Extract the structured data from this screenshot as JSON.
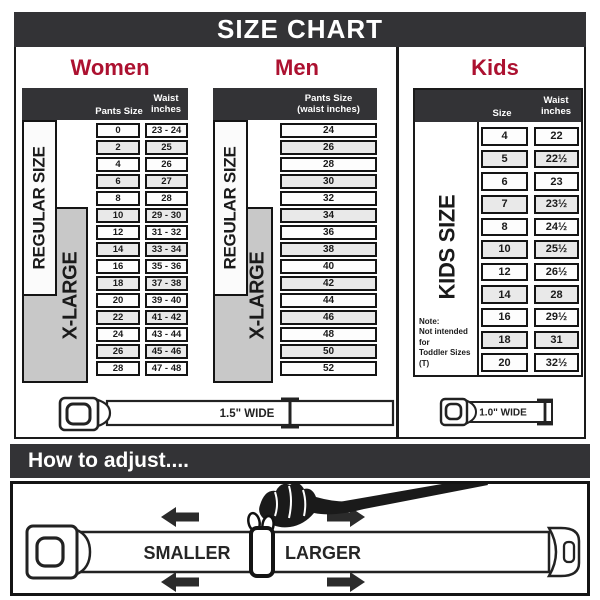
{
  "title": "SIZE CHART",
  "colors": {
    "banner_bg": "#333336",
    "accent_red": "#ac1130",
    "gray_box": "#c8c8c8",
    "border_black": "#1a1a1a"
  },
  "sections": {
    "women": {
      "label": "Women",
      "col1_header": "Pants Size",
      "col2_header_line1": "Waist",
      "col2_header_line2": "inches",
      "regular_label": "REGULAR SIZE",
      "xlarge_label": "X-LARGE"
    },
    "men": {
      "label": "Men",
      "header_line1": "Pants Size",
      "header_line2": "(waist inches)",
      "regular_label": "REGULAR SIZE",
      "xlarge_label": "X-LARGE"
    },
    "kids": {
      "label": "Kids",
      "col1_header": "Size",
      "col2_header_line1": "Waist",
      "col2_header_line2": "inches",
      "side_label": "KIDS SIZE",
      "note_line1": "Note:",
      "note_line2": "Not intended for",
      "note_line3": "Toddler Sizes (T)"
    }
  },
  "belts": {
    "adult_width_label": "1.5\" WIDE",
    "kids_width_label": "1.0\" WIDE"
  },
  "adjust": {
    "title": "How to adjust....",
    "smaller_label": "SMALLER",
    "larger_label": "LARGER"
  },
  "chart_data": [
    {
      "type": "table",
      "title": "Women",
      "columns": [
        "Pants Size",
        "Waist inches"
      ],
      "rows": [
        [
          "0",
          "23 - 24"
        ],
        [
          "2",
          "25"
        ],
        [
          "4",
          "26"
        ],
        [
          "6",
          "27"
        ],
        [
          "8",
          "28"
        ],
        [
          "10",
          "29 - 30"
        ],
        [
          "12",
          "31 - 32"
        ],
        [
          "14",
          "33 - 34"
        ],
        [
          "16",
          "35 - 36"
        ],
        [
          "18",
          "37 - 38"
        ],
        [
          "20",
          "39 - 40"
        ],
        [
          "22",
          "41 - 42"
        ],
        [
          "24",
          "43 - 44"
        ],
        [
          "26",
          "45 - 46"
        ],
        [
          "28",
          "47 - 48"
        ]
      ]
    },
    {
      "type": "table",
      "title": "Men",
      "columns": [
        "Pants Size (waist inches)"
      ],
      "rows": [
        [
          "24"
        ],
        [
          "26"
        ],
        [
          "28"
        ],
        [
          "30"
        ],
        [
          "32"
        ],
        [
          "34"
        ],
        [
          "36"
        ],
        [
          "38"
        ],
        [
          "40"
        ],
        [
          "42"
        ],
        [
          "44"
        ],
        [
          "46"
        ],
        [
          "48"
        ],
        [
          "50"
        ],
        [
          "52"
        ]
      ]
    },
    {
      "type": "table",
      "title": "Kids",
      "columns": [
        "Size",
        "Waist inches"
      ],
      "rows": [
        [
          "4",
          "22"
        ],
        [
          "5",
          "22½"
        ],
        [
          "6",
          "23"
        ],
        [
          "7",
          "23½"
        ],
        [
          "8",
          "24½"
        ],
        [
          "10",
          "25½"
        ],
        [
          "12",
          "26½"
        ],
        [
          "14",
          "28"
        ],
        [
          "16",
          "29½"
        ],
        [
          "18",
          "31"
        ],
        [
          "20",
          "32½"
        ]
      ]
    }
  ]
}
